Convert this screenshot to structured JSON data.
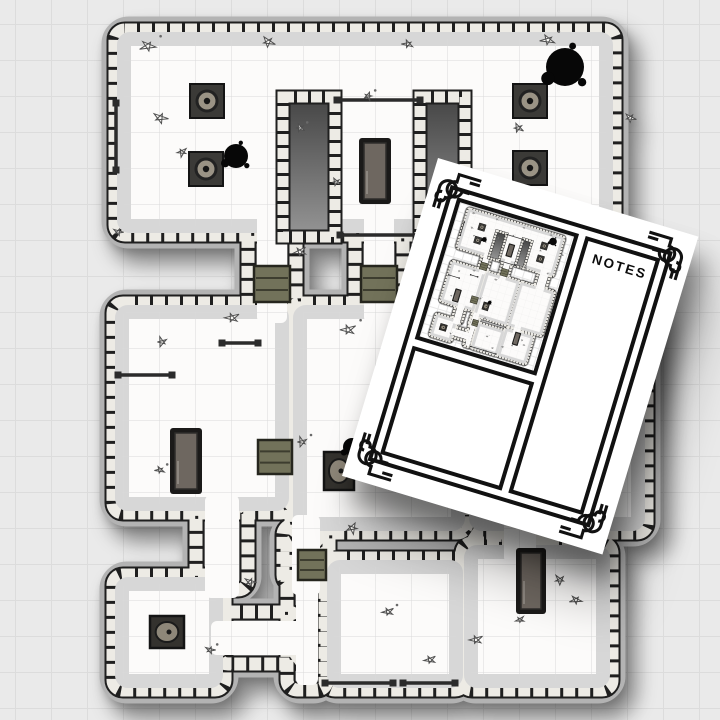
{
  "scene": {
    "background": "#eaeaea",
    "grid_line": "#dcdcdc",
    "grid_size": 36
  },
  "sheet": {
    "notes_label": "NOTES",
    "paper_color": "#ffffff",
    "ink_color": "#111111"
  },
  "map": {
    "palette": {
      "halo": "#b3b3b3",
      "outline": "#1f1f1f",
      "stone": "#edebe5",
      "floor": "#fcfbfa",
      "band": "#d7d7d7",
      "grid": "#dadada",
      "dark_top": "#454545",
      "dark_bottom": "#969696",
      "door": "#72725a",
      "door_edge": "#26261e",
      "door_step": "#3d3d2f",
      "gate": "#2b2b2b",
      "table_frame": "#1b1a19",
      "table_top": "#6e6760",
      "pillar_base": "#3b3a37",
      "pillar_ring": "#9a9385",
      "ink": "#070707",
      "debris_edge": "#4f4f4f",
      "debris_fill": "#faf9f6"
    },
    "shapes": [
      {
        "wall": [
          115,
          30,
          500,
          205
        ],
        "floor": [
          124,
          39,
          482,
          187
        ],
        "band": true
      },
      {
        "wall": [
          113,
          303,
          178,
          210
        ],
        "floor": [
          122,
          312,
          160,
          192
        ],
        "band": true
      },
      {
        "wall": [
          291,
          303,
          176,
          230
        ],
        "floor": [
          300,
          312,
          158,
          212
        ],
        "band": true
      },
      {
        "wall": [
          467,
          303,
          180,
          230
        ],
        "floor": [
          476,
          312,
          162,
          212
        ],
        "band": true
      },
      {
        "wall": [
          113,
          575,
          112,
          115
        ],
        "floor": [
          122,
          584,
          94,
          97
        ],
        "band": true
      },
      {
        "wall": [
          325,
          558,
          140,
          132
        ],
        "floor": [
          334,
          567,
          122,
          114
        ],
        "band": true
      },
      {
        "wall": [
          462,
          543,
          150,
          147
        ],
        "floor": [
          471,
          552,
          132,
          129
        ],
        "band": true
      },
      {
        "wall": [
          248,
          215,
          48,
          100
        ],
        "floor": [
          257,
          205,
          30,
          118
        ],
        "band": false
      },
      {
        "wall": [
          355,
          215,
          48,
          100
        ],
        "floor": [
          364,
          205,
          30,
          118
        ],
        "band": false
      },
      {
        "wall": [
          540,
          215,
          60,
          100
        ],
        "floor": [
          549,
          205,
          42,
          118
        ],
        "band": false
      },
      {
        "wall": [
          196,
          505,
          52,
          85
        ],
        "floor": [
          205,
          495,
          34,
          103
        ],
        "band": false
      },
      {
        "wall": [
          283,
          525,
          46,
          60
        ],
        "floor": [
          292,
          515,
          28,
          80
        ],
        "band": false
      },
      {
        "wall": [
          218,
          612,
          80,
          52
        ],
        "floor": [
          211,
          621,
          104,
          34
        ],
        "band": false
      },
      {
        "wall": [
          287,
          540,
          40,
          150
        ],
        "floor": [
          296,
          530,
          22,
          155
        ],
        "band": false
      },
      {
        "wall": [
          495,
          495,
          50,
          60
        ],
        "floor": [
          504,
          485,
          32,
          78
        ],
        "band": false
      }
    ],
    "blocks": [
      [
        283,
        97,
        52,
        140
      ],
      [
        420,
        97,
        45,
        140
      ]
    ],
    "doors": [
      [
        254,
        266,
        36,
        36
      ],
      [
        361,
        266,
        36,
        36
      ],
      [
        258,
        440,
        34,
        34
      ],
      [
        298,
        550,
        28,
        30
      ]
    ],
    "gates": [
      [
        116,
        103,
        116,
        170
      ],
      [
        337,
        100,
        420,
        100
      ],
      [
        340,
        235,
        420,
        235
      ],
      [
        118,
        375,
        172,
        375
      ],
      [
        222,
        343,
        258,
        343
      ],
      [
        325,
        683,
        393,
        683
      ],
      [
        403,
        683,
        455,
        683
      ]
    ],
    "pillars": [
      [
        207,
        101
      ],
      [
        206,
        169
      ],
      [
        530,
        101
      ],
      [
        530,
        168
      ]
    ],
    "tables": [
      [
        359,
        138,
        32,
        66
      ],
      [
        170,
        428,
        32,
        66
      ],
      [
        516,
        548,
        30,
        66
      ]
    ],
    "hearths": [
      [
        324,
        452,
        30,
        38
      ],
      [
        150,
        616,
        34,
        32
      ]
    ],
    "blots": [
      [
        565,
        67,
        19
      ],
      [
        236,
        156,
        12
      ],
      [
        352,
        447,
        9
      ]
    ],
    "debris": [
      [
        148,
        46,
        7
      ],
      [
        268,
        42,
        6
      ],
      [
        408,
        44,
        5
      ],
      [
        548,
        40,
        6
      ],
      [
        160,
        118,
        6
      ],
      [
        182,
        152,
        5
      ],
      [
        300,
        128,
        4
      ],
      [
        518,
        128,
        5
      ],
      [
        472,
        226,
        7
      ],
      [
        445,
        238,
        5
      ],
      [
        300,
        252,
        6
      ],
      [
        232,
        318,
        6
      ],
      [
        348,
        330,
        7
      ],
      [
        162,
        342,
        5
      ],
      [
        118,
        232,
        4
      ],
      [
        302,
        442,
        5
      ],
      [
        352,
        528,
        6
      ],
      [
        250,
        582,
        5
      ],
      [
        388,
        612,
        5
      ],
      [
        476,
        640,
        6
      ],
      [
        576,
        600,
        5
      ],
      [
        160,
        470,
        4
      ],
      [
        630,
        118,
        5
      ],
      [
        586,
        226,
        5
      ],
      [
        210,
        650,
        4
      ],
      [
        430,
        660,
        5
      ],
      [
        520,
        620,
        4
      ],
      [
        368,
        96,
        4
      ],
      [
        336,
        182,
        4
      ],
      [
        560,
        580,
        5
      ]
    ]
  }
}
